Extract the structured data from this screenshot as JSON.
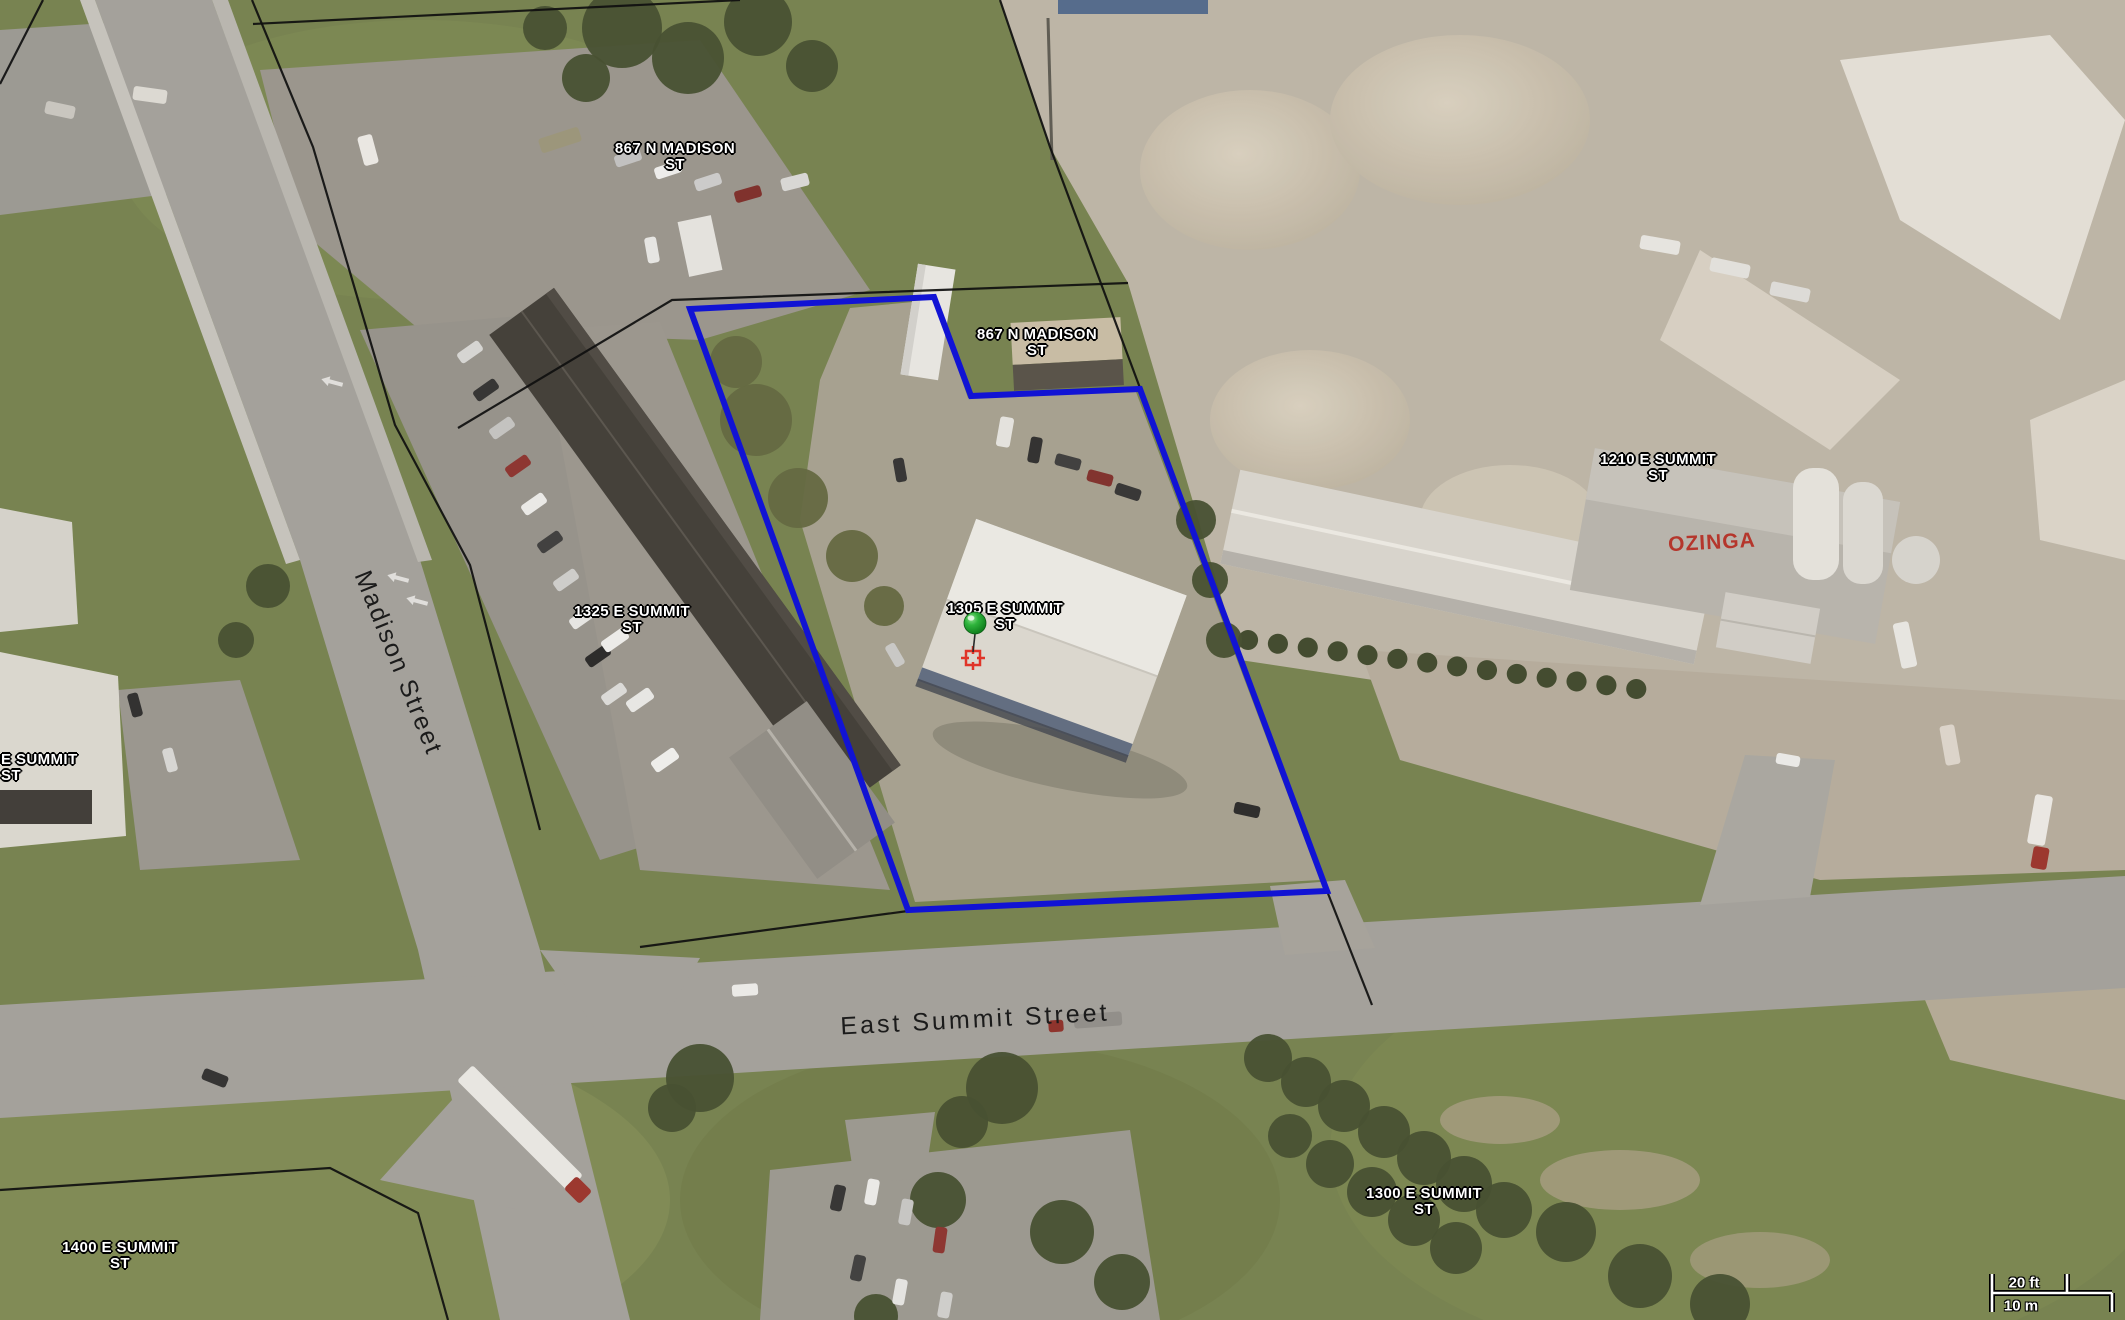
{
  "map": {
    "address_labels": [
      {
        "line1": "867 N MADISON",
        "line2": "ST"
      },
      {
        "line1": "867 N MADISON",
        "line2": "ST"
      },
      {
        "line1": "1210 E SUMMIT",
        "line2": "ST"
      },
      {
        "line1": "1325 E SUMMIT",
        "line2": "ST"
      },
      {
        "line1": "1305 E SUMMIT",
        "line2": "ST"
      },
      {
        "line1": "E SUMMIT",
        "line2": "ST"
      },
      {
        "line1": "1400 E SUMMIT",
        "line2": "ST"
      },
      {
        "line1": "1300 E SUMMIT",
        "line2": "ST"
      }
    ],
    "road_labels": [
      {
        "text": "Madison Street"
      },
      {
        "text": "East Summit Street"
      }
    ],
    "business_sign": {
      "text": "OZINGA",
      "color": "#b5362c"
    },
    "scale_bar": {
      "imperial": "20 ft",
      "metric": "10 m"
    },
    "colors": {
      "selection_blue": "#1113d4",
      "parcel_black": "#0f0f0f",
      "label_text": "#ffffff",
      "marker_green": "#2fb43c",
      "crosshair_red": "#e03428"
    },
    "selected_parcel": {
      "points": "690,309 934,297 971,396 1140,389 1327,891 908,910"
    },
    "parcel_lines": [
      "252,0 313,147 395,425 470,565 540,830",
      "253,24 740,0",
      "458,428 672,300 1128,283",
      "1000,0 1050,147 1140,388",
      "640,947 908,911",
      "1327,891 1372,1005",
      "0,84 43,0",
      "0,1190 330,1168 418,1213 448,1320"
    ]
  },
  "decor": {
    "trees": [
      [
        622,
        28,
        40
      ],
      [
        688,
        58,
        36
      ],
      [
        758,
        22,
        34
      ],
      [
        812,
        66,
        26
      ],
      [
        586,
        78,
        24
      ],
      [
        545,
        28,
        22
      ],
      [
        756,
        420,
        36,
        "#5f653c"
      ],
      [
        798,
        498,
        30,
        "#5f653c"
      ],
      [
        852,
        556,
        26,
        "#5f653c"
      ],
      [
        736,
        362,
        26,
        "#5f653c"
      ],
      [
        884,
        606,
        20,
        "#5f653c"
      ],
      [
        268,
        586,
        22
      ],
      [
        236,
        640,
        18
      ],
      [
        700,
        1078,
        34
      ],
      [
        672,
        1108,
        24
      ],
      [
        1002,
        1088,
        36
      ],
      [
        962,
        1122,
        26
      ],
      [
        938,
        1200,
        28
      ],
      [
        1062,
        1232,
        32
      ],
      [
        1122,
        1282,
        28
      ],
      [
        876,
        1316,
        22
      ],
      [
        1268,
        1058,
        24
      ],
      [
        1306,
        1082,
        25
      ],
      [
        1344,
        1106,
        26
      ],
      [
        1384,
        1132,
        26
      ],
      [
        1424,
        1158,
        27
      ],
      [
        1464,
        1184,
        28
      ],
      [
        1504,
        1210,
        28
      ],
      [
        1290,
        1136,
        22
      ],
      [
        1330,
        1164,
        24
      ],
      [
        1372,
        1192,
        25
      ],
      [
        1414,
        1220,
        26
      ],
      [
        1456,
        1248,
        26
      ],
      [
        1566,
        1232,
        30
      ],
      [
        1640,
        1276,
        32
      ],
      [
        1720,
        1304,
        30
      ],
      [
        1196,
        520,
        20
      ],
      [
        1210,
        580,
        18
      ],
      [
        1224,
        640,
        18
      ]
    ],
    "vehicles": [
      [
        560,
        140,
        42,
        15,
        -18,
        "#9a9479"
      ],
      [
        628,
        158,
        27,
        12,
        -18,
        "#c2c2c2"
      ],
      [
        668,
        170,
        27,
        12,
        -18,
        "#f0f0ee"
      ],
      [
        708,
        182,
        27,
        12,
        -18,
        "#cccccc"
      ],
      [
        748,
        194,
        27,
        12,
        -16,
        "#7c2a26"
      ],
      [
        795,
        182,
        28,
        13,
        -14,
        "#d9d9d7"
      ],
      [
        652,
        250,
        26,
        12,
        -100,
        "#e8e8e6"
      ],
      [
        368,
        150,
        30,
        15,
        75,
        "#eceae6"
      ],
      [
        150,
        95,
        34,
        14,
        8,
        "#dddbd5"
      ],
      [
        60,
        110,
        30,
        13,
        12,
        "#c9c7c1"
      ],
      [
        470,
        352,
        26,
        12,
        -35,
        "#d7d7d5"
      ],
      [
        486,
        390,
        26,
        12,
        -35,
        "#2e2e2e"
      ],
      [
        502,
        428,
        26,
        12,
        -35,
        "#c4c4c2"
      ],
      [
        518,
        466,
        26,
        12,
        -35,
        "#8b2f2b"
      ],
      [
        534,
        504,
        26,
        12,
        -35,
        "#ececea"
      ],
      [
        550,
        542,
        26,
        12,
        -35,
        "#3a3a3a"
      ],
      [
        566,
        580,
        26,
        12,
        -35,
        "#cfcfcd"
      ],
      [
        582,
        618,
        26,
        12,
        -35,
        "#e8e8e6"
      ],
      [
        598,
        656,
        26,
        12,
        -35,
        "#242424"
      ],
      [
        614,
        694,
        26,
        12,
        -35,
        "#dcdcda"
      ],
      [
        615,
        640,
        28,
        13,
        -35,
        "#eeeeec"
      ],
      [
        640,
        700,
        28,
        13,
        -35,
        "#e9e9e7"
      ],
      [
        665,
        760,
        28,
        13,
        -35,
        "#f1f1ef"
      ],
      [
        1035,
        450,
        26,
        12,
        100,
        "#2b2b2b"
      ],
      [
        1068,
        462,
        26,
        12,
        15,
        "#3a3a3a"
      ],
      [
        1100,
        478,
        26,
        12,
        15,
        "#7e2c28"
      ],
      [
        1128,
        492,
        26,
        12,
        18,
        "#303030"
      ],
      [
        1005,
        432,
        30,
        14,
        100,
        "#e6e5e1"
      ],
      [
        900,
        470,
        24,
        11,
        80,
        "#2f2f2f"
      ],
      [
        895,
        655,
        24,
        11,
        60,
        "#c9c9c7"
      ],
      [
        1247,
        810,
        26,
        12,
        12,
        "#262626"
      ],
      [
        1660,
        245,
        40,
        14,
        10,
        "#e8e7e3"
      ],
      [
        1730,
        268,
        40,
        14,
        12,
        "#e4e3df"
      ],
      [
        1790,
        292,
        40,
        14,
        12,
        "#dfdeda"
      ],
      [
        1905,
        645,
        46,
        16,
        78,
        "#e9e8e4"
      ],
      [
        1950,
        745,
        40,
        15,
        80,
        "#ded6cc"
      ],
      [
        1788,
        760,
        24,
        11,
        10,
        "#ececea"
      ],
      [
        2040,
        820,
        50,
        18,
        100,
        "#eceae6"
      ],
      [
        2040,
        858,
        22,
        16,
        100,
        "#993028"
      ],
      [
        215,
        1078,
        26,
        12,
        22,
        "#2d2d2d"
      ],
      [
        745,
        990,
        26,
        12,
        -4,
        "#ededeb"
      ],
      [
        1056,
        1026,
        15,
        12,
        -4,
        "#8c2c26"
      ],
      [
        1098,
        1020,
        48,
        14,
        -4,
        "#8f8d88"
      ],
      [
        520,
        1128,
        156,
        22,
        45,
        "#eae9e5"
      ],
      [
        578,
        1190,
        22,
        18,
        45,
        "#9a3028"
      ],
      [
        838,
        1198,
        26,
        12,
        102,
        "#2f2f2f"
      ],
      [
        872,
        1192,
        26,
        12,
        100,
        "#ececea"
      ],
      [
        906,
        1212,
        26,
        12,
        100,
        "#c7c7c5"
      ],
      [
        940,
        1240,
        26,
        12,
        98,
        "#8b2f2b"
      ],
      [
        858,
        1268,
        26,
        12,
        102,
        "#3b3b3b"
      ],
      [
        900,
        1292,
        26,
        12,
        100,
        "#e6e6e4"
      ],
      [
        945,
        1305,
        26,
        12,
        100,
        "#d0d0ce"
      ],
      [
        135,
        705,
        24,
        11,
        75,
        "#2a2a2a"
      ],
      [
        170,
        760,
        24,
        11,
        75,
        "#d8d8d6"
      ]
    ]
  }
}
